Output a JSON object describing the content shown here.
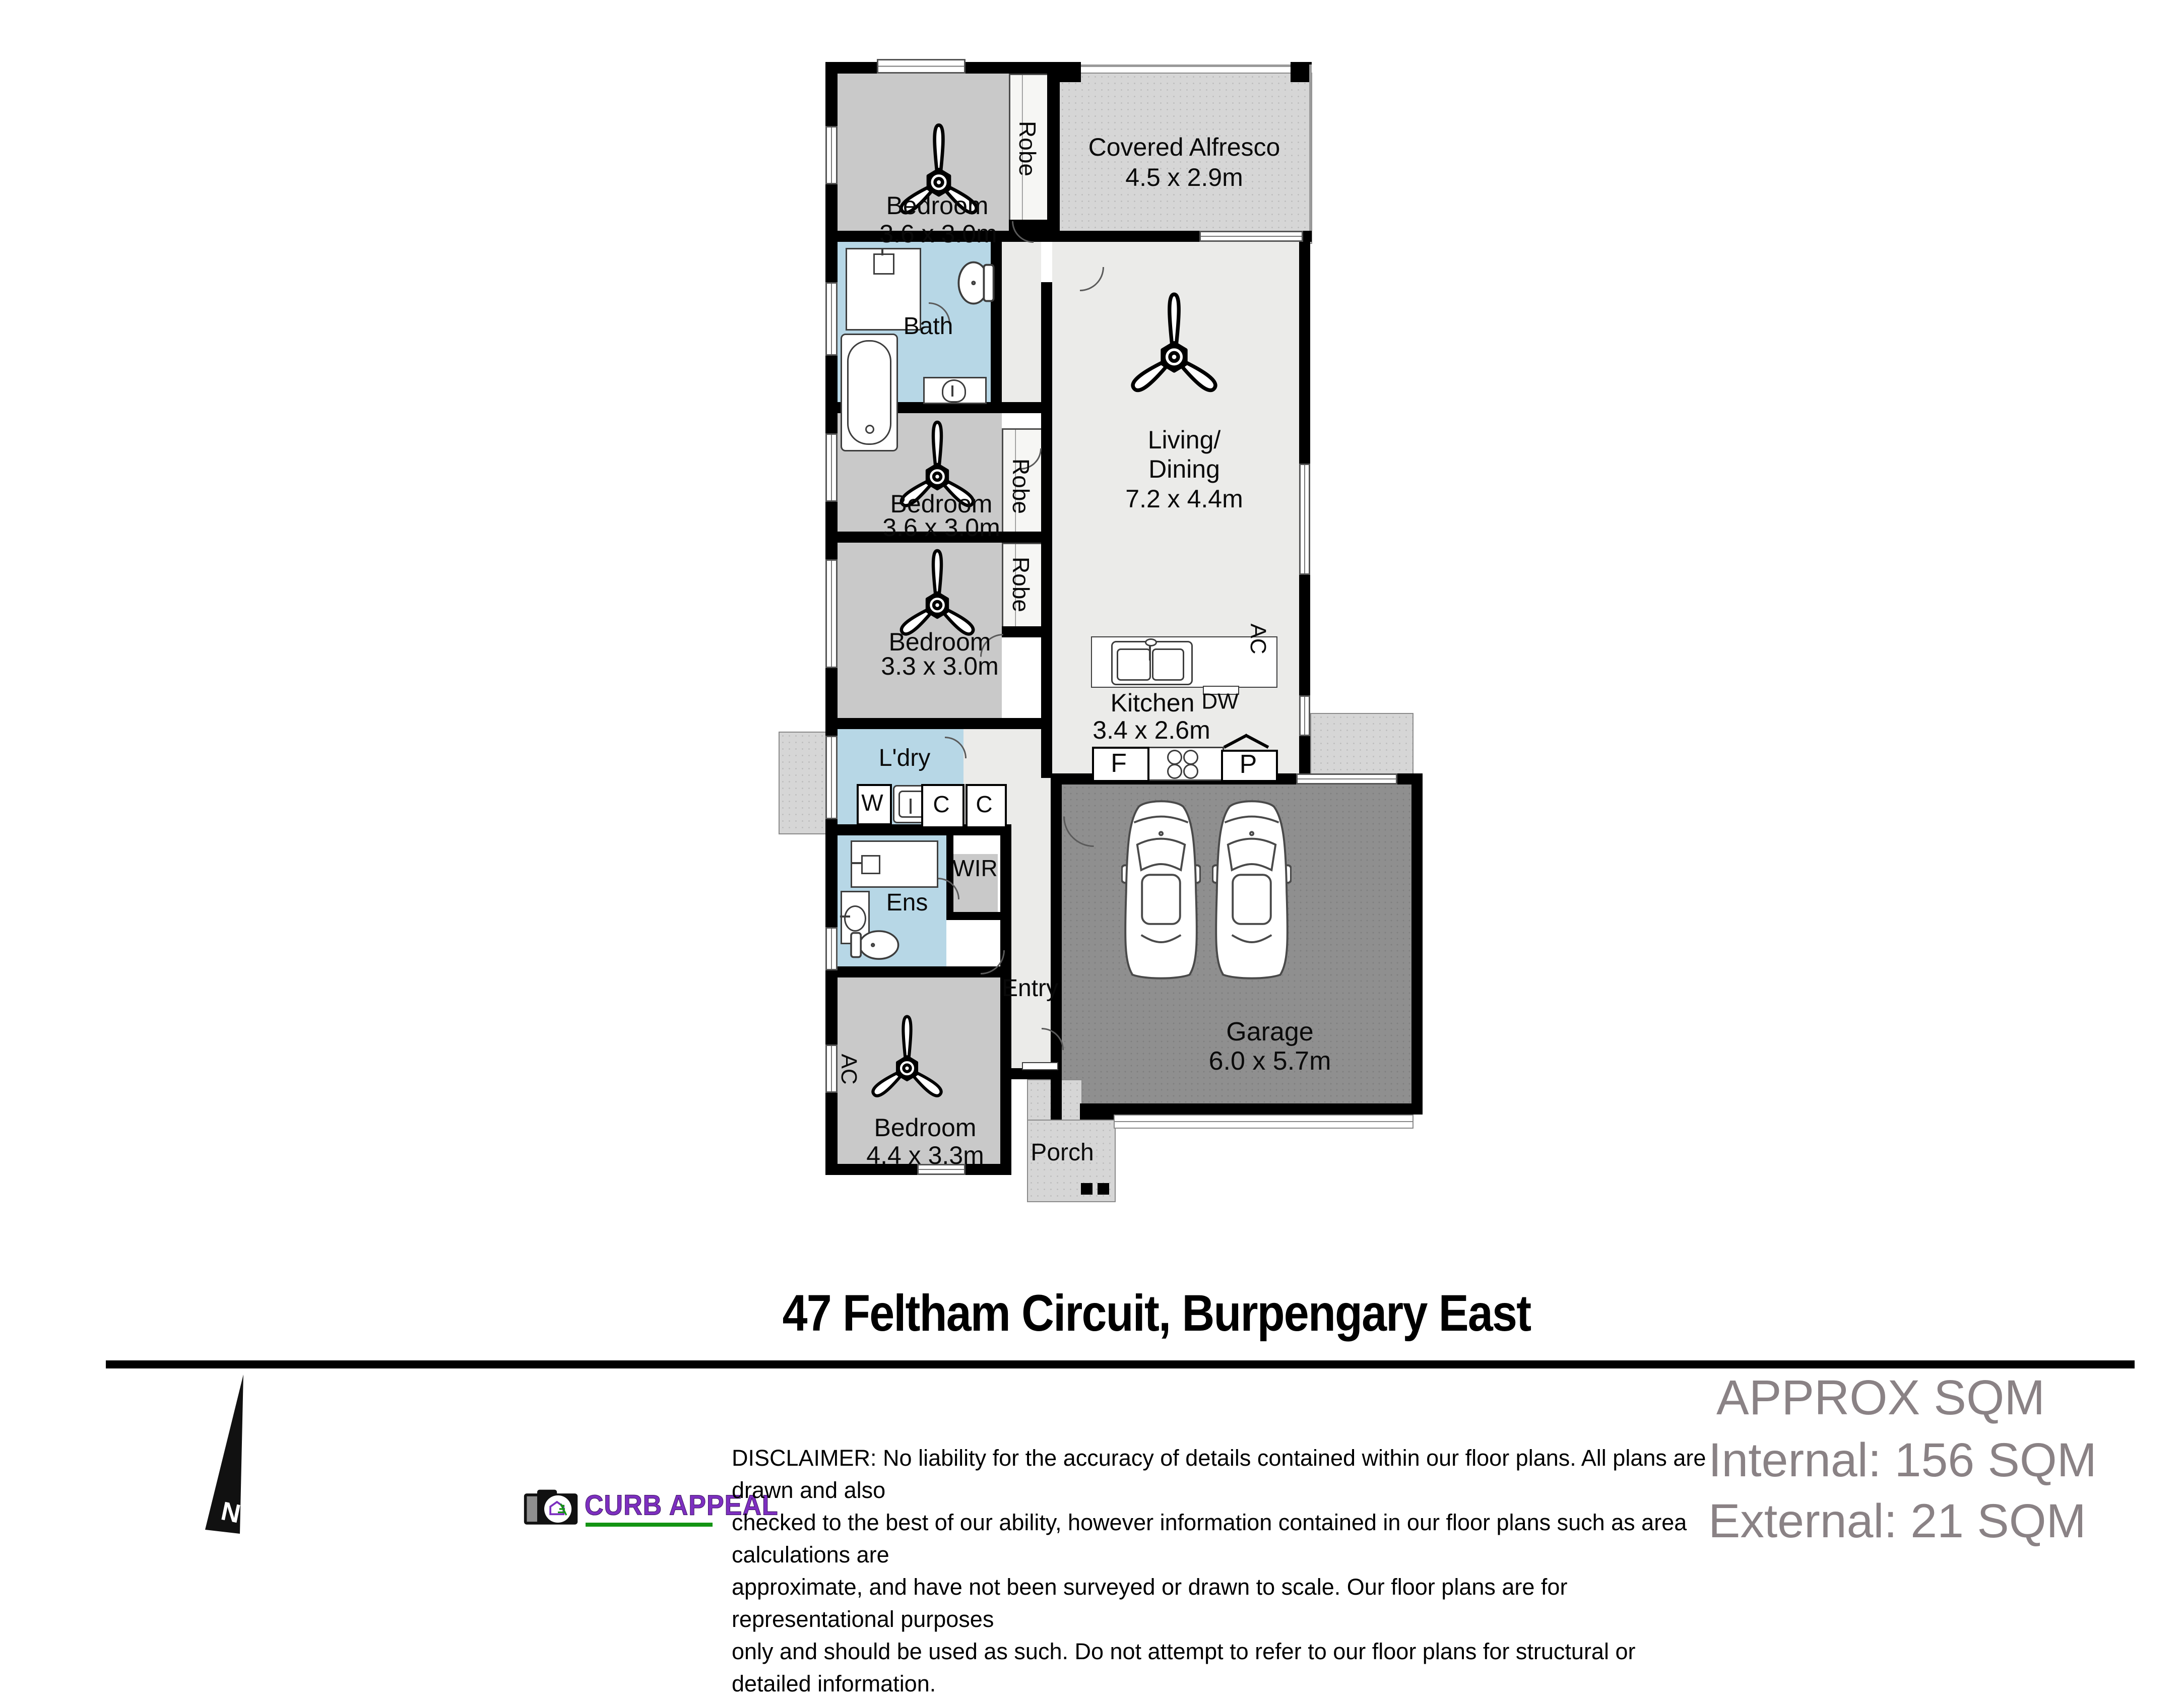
{
  "plan": {
    "bedroom1": {
      "name": "Bedroom",
      "dims": "3.6 x 3.0m"
    },
    "robe1": "Robe",
    "robe2": "Robe",
    "robe3": "Robe",
    "alfresco": {
      "name": "Covered Alfresco",
      "dims": "4.5 x 2.9m"
    },
    "bath": {
      "name": "Bath"
    },
    "living": {
      "line1": "Living/",
      "line2": "Dining",
      "dims": "7.2 x 4.4m"
    },
    "bedroom2": {
      "name": "Bedroom",
      "dims": "3.6 x 3.0m"
    },
    "bedroom3": {
      "name": "Bedroom",
      "dims": "3.3 x 3.0m"
    },
    "kitchen": {
      "name": "Kitchen",
      "dims": "3.4 x 2.6m",
      "fridge": "F",
      "dishwasher": "DW",
      "pantry": "P"
    },
    "laundry": {
      "name": "L'dry",
      "washer": "W",
      "cupboard1": "C",
      "cupboard2": "C"
    },
    "ensuite": {
      "name": "Ens"
    },
    "wir": {
      "name": "WIR"
    },
    "entry": {
      "name": "Entry"
    },
    "master": {
      "name": "Bedroom",
      "dims": "4.4 x 3.3m"
    },
    "garage": {
      "name": "Garage",
      "dims": "6.0 x 5.7m"
    },
    "porch": {
      "name": "Porch"
    },
    "ac_kitchen": "AC",
    "ac_master": "AC"
  },
  "footer": {
    "title": "47 Feltham Circuit, Burpengary East",
    "north_label": "N",
    "logo_text": "CURB APPEAL",
    "disclaimer_line1": "DISCLAIMER: No liability for the accuracy of details contained within our floor plans. All plans are drawn and also",
    "disclaimer_line2": "checked to the best of our ability, however information contained in our floor plans such as area calculations are",
    "disclaimer_line3": "approximate, and have not been surveyed or drawn to scale. Our floor plans are for representational purposes",
    "disclaimer_line4": "only and should be used as such. Do not attempt to refer to our floor plans for structural or detailed information.",
    "approx_heading": "APPROX SQM",
    "approx_internal": "Internal: 156 SQM",
    "approx_external": "External: 21 SQM"
  },
  "colors": {
    "wet_area_blue": "#b7d7e6",
    "bedroom_gray": "#c9c9c9",
    "open_area_gray": "#ebebe9",
    "outdoor_speckle_gray": "#d6d6d6",
    "garage_gray": "#8f8f8f",
    "sqm_text_gray": "#8a8285",
    "logo_purple": "#7d2fc0",
    "logo_green": "#149414"
  }
}
